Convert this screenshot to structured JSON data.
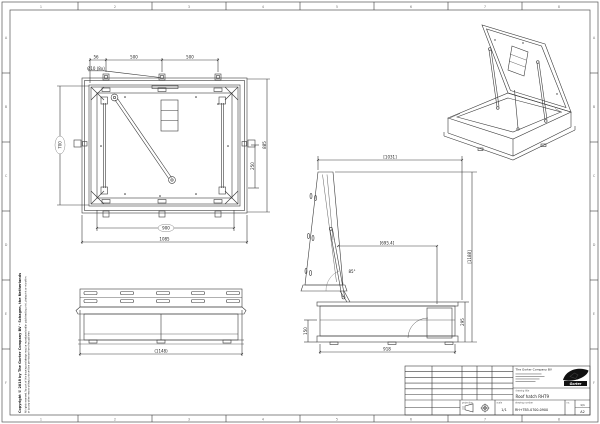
{
  "frame": {
    "columns": [
      "1",
      "2",
      "3",
      "4",
      "5",
      "6",
      "7",
      "8"
    ],
    "rows": [
      "A",
      "B",
      "C",
      "D",
      "E",
      "F"
    ]
  },
  "copyright": {
    "line1": "Copyright © 2018 by The Gorter Company BV - Schagen, the Netherlands",
    "line2": "All rights reserved. No part of this drawing and design may be reproduced and/or published by print, photoprint or microfilm",
    "line3": "or by any other means without prior written permission from the publisher."
  },
  "plan": {
    "dim_a": "56",
    "dim_b": "500",
    "dim_c": "500",
    "hole_note": "Ø10 (8x)",
    "dim_left": "700",
    "dim_right": "885",
    "dim_right_inner": "250",
    "dim_bottom_inner": "900",
    "dim_bottom": "1085"
  },
  "front": {
    "dim_width": "(1148)"
  },
  "side": {
    "dim_top": "[1031]",
    "dim_height": "[1188]",
    "dim_reach": "[695.4]",
    "dim_angle": "85°",
    "dim_base": "918",
    "dim_left": "150",
    "dim_right": "295"
  },
  "title_block": {
    "company": "The Gorter Company BV",
    "logo_text": "Gorter",
    "label_title": "drawing title",
    "product_title": "Roof hatch RHT9",
    "label_projection": "projection",
    "label_scale": "scale",
    "scale": "1/1",
    "label_number": "drawing number",
    "number": "RH+TB5-0700-0900",
    "label_no": "no.",
    "sheet": "1/1",
    "format": "A2"
  }
}
